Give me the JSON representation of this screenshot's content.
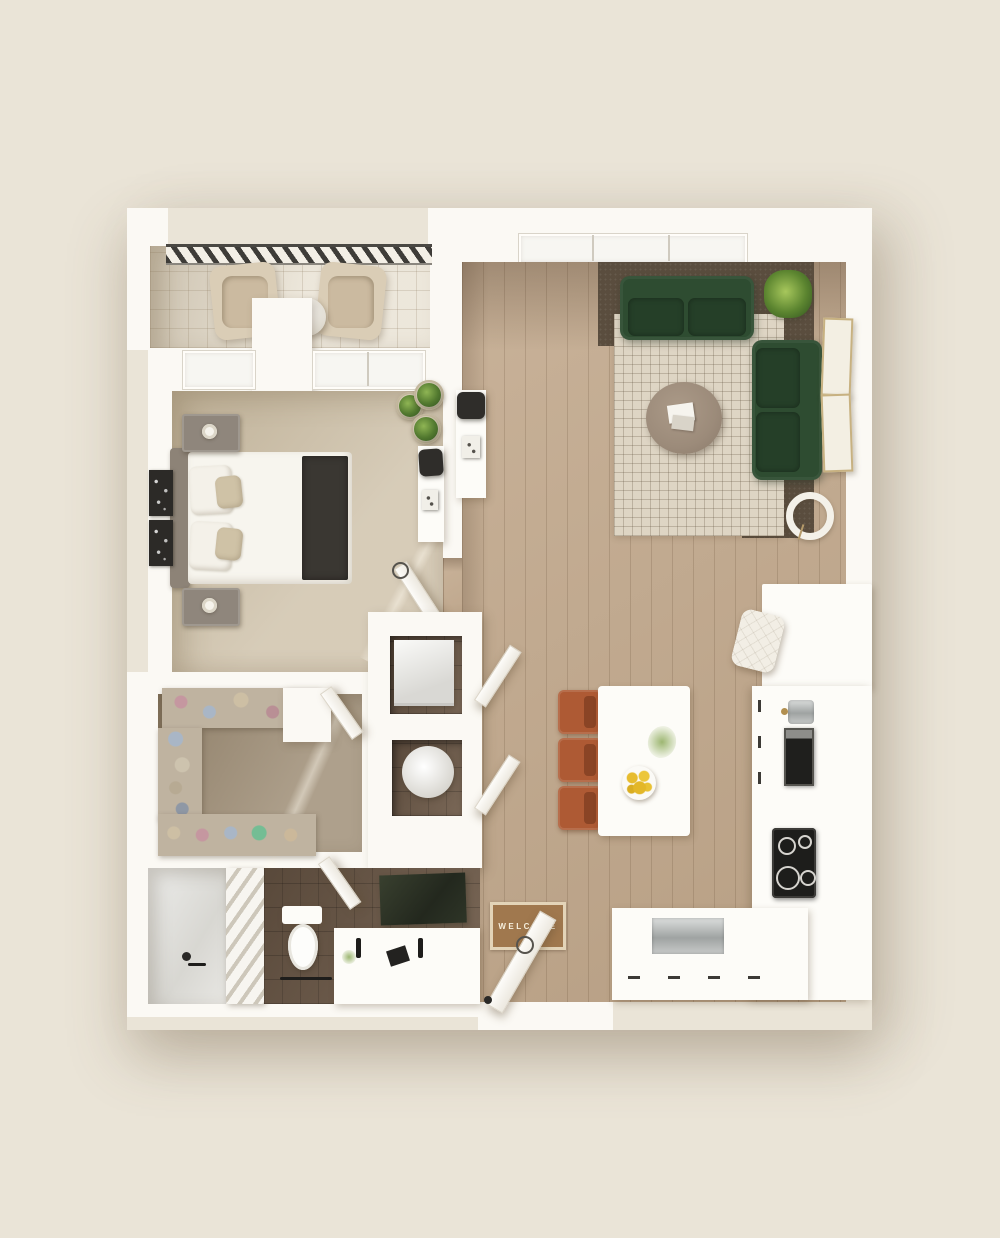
{
  "scene": {
    "title": "one-bedroom apartment 3D floor plan, top-down view",
    "style": "3d-render"
  },
  "labels": {
    "welcome_mat": "WELCOME"
  },
  "colors": {
    "bg": "#eae4d7",
    "wall": "#fbf9f4",
    "wood": "#c2a98d",
    "carpet-bedroom": "#cec1a9",
    "carpet-closet": "#a3937c",
    "tile-balcony": "#e8e1d2",
    "tile-bath": "#6f5b49",
    "rug-cream": "#ded5c4",
    "rug-dark": "#5a4d3e",
    "sofa-green": "#2e4c31",
    "sofa-green-dark": "#253f28",
    "chair-rust": "#ae5a34",
    "chair-rust-dark": "#8a4425",
    "table-wood": "#9c8b7a",
    "headboard": "#8d8377",
    "pillow-beige": "#cfc2a6",
    "runner": "#3a3732",
    "mat-brown": "#a0784e",
    "mat-border": "#e3d4b8",
    "brass": "#b28f4f"
  },
  "rooms": [
    {
      "name": "balcony",
      "items": [
        "railing",
        "lounge-chair",
        "lounge-chair",
        "side-table"
      ]
    },
    {
      "name": "bedroom",
      "items": [
        "double-bed",
        "headboard",
        "nightstand-with-lamp",
        "nightstand-with-lamp",
        "wall-art",
        "wall-art",
        "potted-plants",
        "desk",
        "desk-chair",
        "windows",
        "door"
      ]
    },
    {
      "name": "living-room",
      "items": [
        "sofa",
        "loveseat",
        "area-rug",
        "dark-rug",
        "round-coffee-table",
        "magazines",
        "palm-plant",
        "picture-frame",
        "picture-frame",
        "arc-floor-lamp",
        "console-desk",
        "desk-chair",
        "window-strip"
      ]
    },
    {
      "name": "kitchen",
      "items": [
        "bar-counter",
        "tufted-stool",
        "sink",
        "oven",
        "cooktop",
        "cabinet-run",
        "dishwasher",
        "base-cabinets"
      ]
    },
    {
      "name": "dining",
      "items": [
        "dining-table",
        "dining-chair",
        "dining-chair",
        "dining-chair",
        "lemon-bowl",
        "plant-sprig"
      ]
    },
    {
      "name": "utility",
      "items": [
        "washer",
        "water-heater",
        "closet-door",
        "closet-door"
      ]
    },
    {
      "name": "walk-in-closet",
      "items": [
        "wire-shelf-clothes",
        "wire-shelf-clothes",
        "wire-shelf-shoes",
        "door"
      ]
    },
    {
      "name": "bathroom",
      "items": [
        "walk-in-shower",
        "towel-rack",
        "toilet",
        "double-vanity",
        "faucet",
        "faucet",
        "mirror",
        "door"
      ]
    },
    {
      "name": "entry",
      "items": [
        "welcome-mat",
        "front-door"
      ]
    }
  ]
}
